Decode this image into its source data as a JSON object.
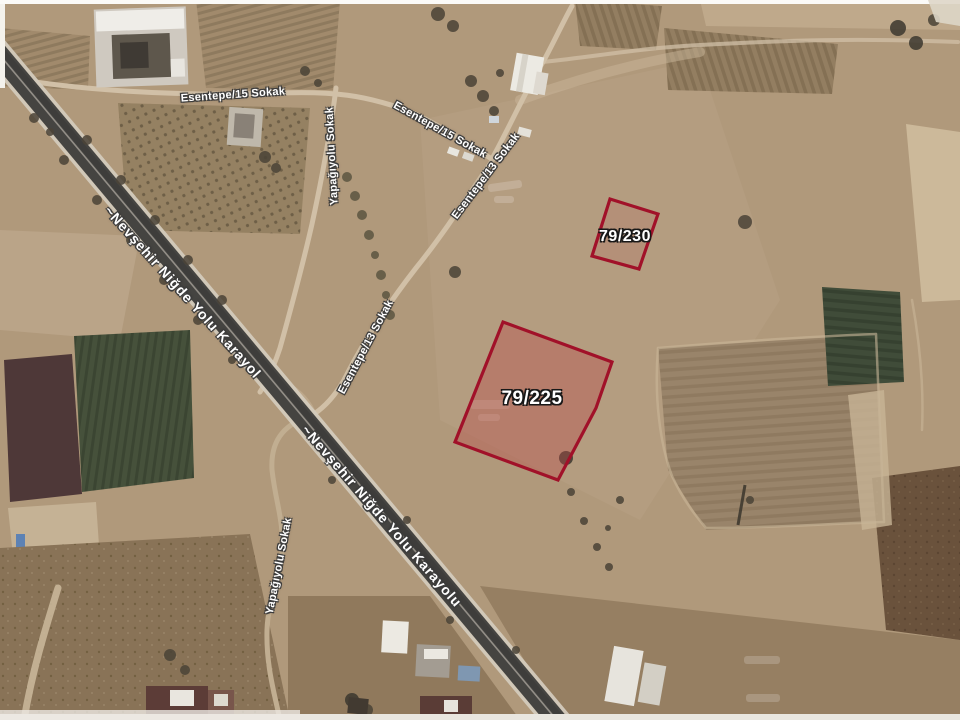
{
  "map": {
    "view": "satellite",
    "road_labels": [
      {
        "text": "Esentepe/15 Sokak",
        "x": 233,
        "y": 95,
        "rot": -4,
        "size": 11
      },
      {
        "text": "Esentepe/15 Sokak",
        "x": 440,
        "y": 130,
        "rot": 29,
        "size": 11
      },
      {
        "text": "Esentepe/13 Sokak",
        "x": 486,
        "y": 176,
        "rot": -53,
        "size": 11
      },
      {
        "text": "Esentepe/13 Sokak",
        "x": 366,
        "y": 347,
        "rot": -62,
        "size": 11
      },
      {
        "text": "Yapağıyolu Sokak",
        "x": 332,
        "y": 156,
        "rot": -93,
        "size": 11
      },
      {
        "text": "Yapağıyolu Sokak",
        "x": 279,
        "y": 566,
        "rot": -79,
        "size": 11
      },
      {
        "text": "~Nevşehir Niğde Yolu Karayol",
        "x": 183,
        "y": 292,
        "rot": 48,
        "size": 14
      },
      {
        "text": "~Nevşehir Niğde Yolu Karayolu",
        "x": 382,
        "y": 516,
        "rot": 49,
        "size": 14
      }
    ],
    "parcels": [
      {
        "id": "79/230",
        "points": "610,199 658,214 639,269 592,256",
        "fill_opacity": 0.15,
        "label_x": 625,
        "label_y": 237,
        "label_size": 16
      },
      {
        "id": "79/225",
        "points": "503,322 612,362 596,408 558,480 455,442",
        "fill_opacity": 0.38,
        "label_x": 532,
        "label_y": 399,
        "label_size": 19
      }
    ],
    "colors": {
      "parcel_stroke": "#a90f28",
      "parcel_fill": "#bf4848",
      "label_text": "#ffffff",
      "label_outline": "#3c3c3c",
      "terrain_base": "#b29979",
      "highway_asphalt": "#454441",
      "road_dirt": "#d2c0a5"
    }
  }
}
